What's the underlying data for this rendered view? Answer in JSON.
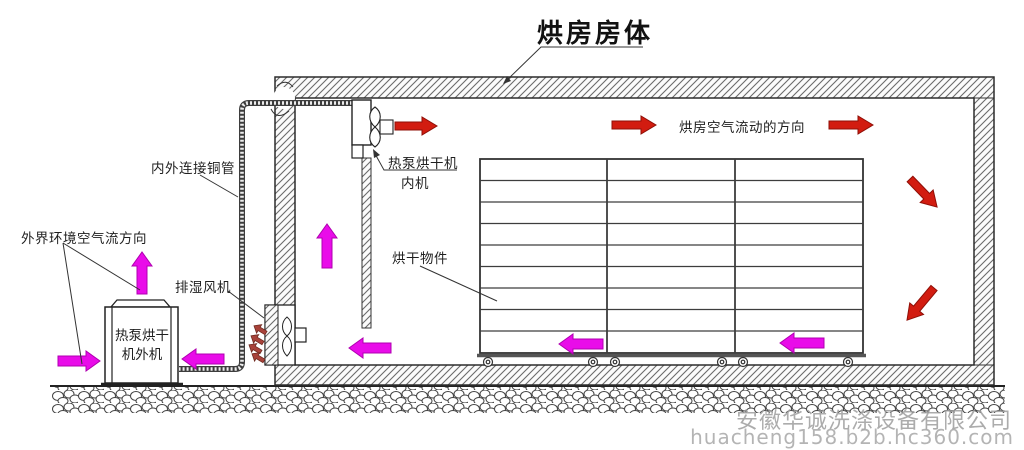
{
  "title": "烘房房体",
  "labels": {
    "copper_pipe": "内外连接铜管",
    "ambient_airflow": "外界环境空气流方向",
    "exhaust_fan": "排湿风机",
    "indoor_unit_line1": "热泵烘干机",
    "indoor_unit_line2": "内机",
    "outdoor_unit_line1": "热泵烘干",
    "outdoor_unit_line2": "机外机",
    "drying_items": "烘干物件",
    "room_airflow": "烘房空气流动的方向"
  },
  "watermark": {
    "company": "安徽华诚洗涤设备有限公司",
    "url": "huacheng158.b2b.hc360.com"
  },
  "colors": {
    "hot_air_arrow": "#d21c10",
    "ambient_air_arrow": "#e90ce9",
    "exhaust_air_arrow": "#a8423a",
    "line": "#333333",
    "watermark_text": "#a0a0a0"
  },
  "icons": {
    "indoor_fan": "axial-fan-icon",
    "exhaust_fan": "axial-fan-icon",
    "pipe_break": "wall-break-icon",
    "wheels": "caster-wheel-icon"
  }
}
